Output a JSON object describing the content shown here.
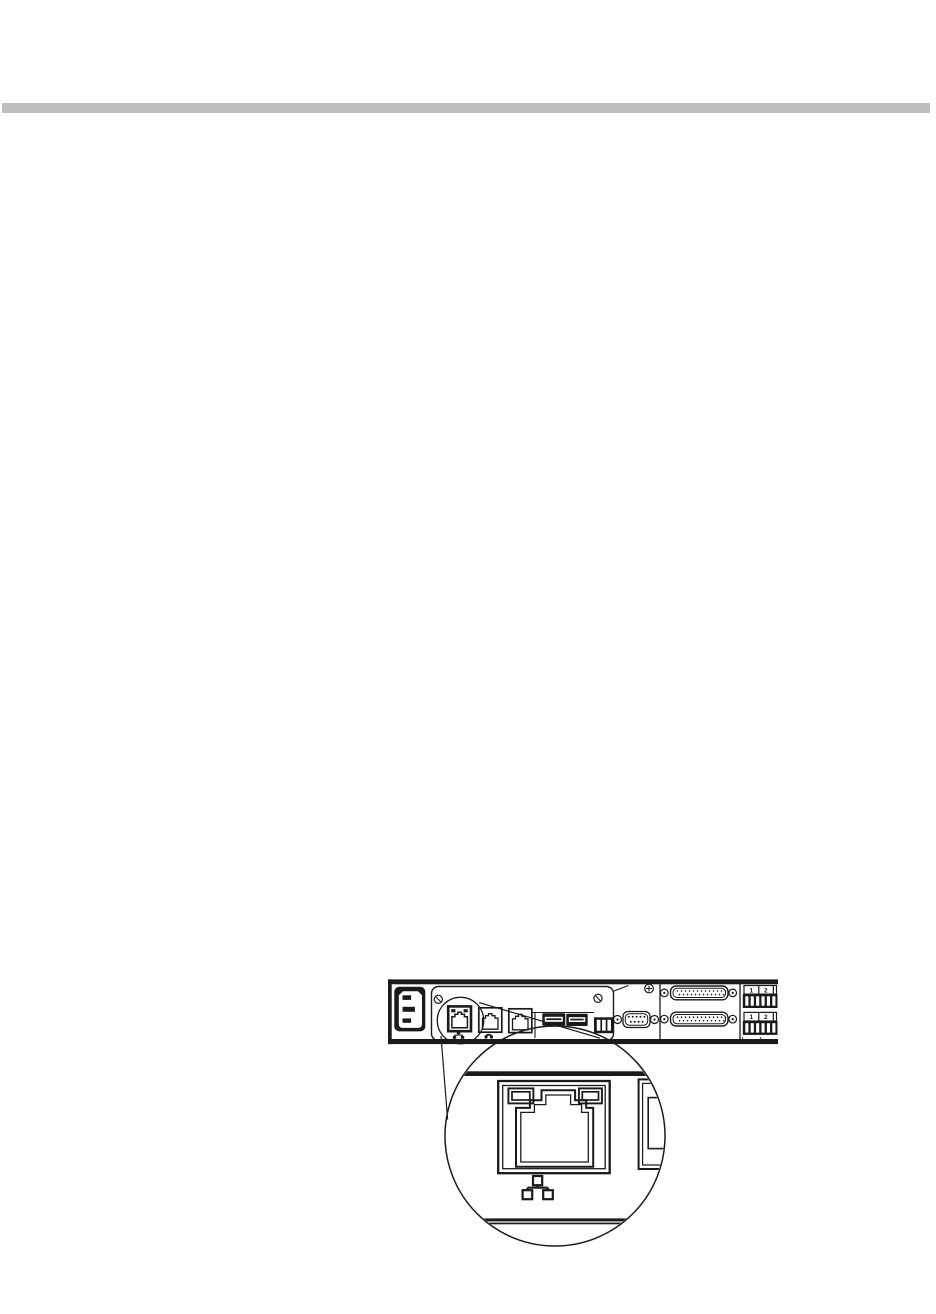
{
  "page": {
    "background_color": "#ffffff",
    "divider_bar_color": "#bdbdbd"
  },
  "figure": {
    "line_color": "#1a1a1a",
    "terminal_block_top": {
      "labels": [
        "1",
        "2"
      ]
    },
    "terminal_block_bottom": {
      "labels": [
        "1",
        "2"
      ],
      "polarity_marks": "+ - +"
    },
    "icons": {
      "network_icon": "three linked squares (ethernet)",
      "phone_icon": "telephone handset"
    }
  }
}
